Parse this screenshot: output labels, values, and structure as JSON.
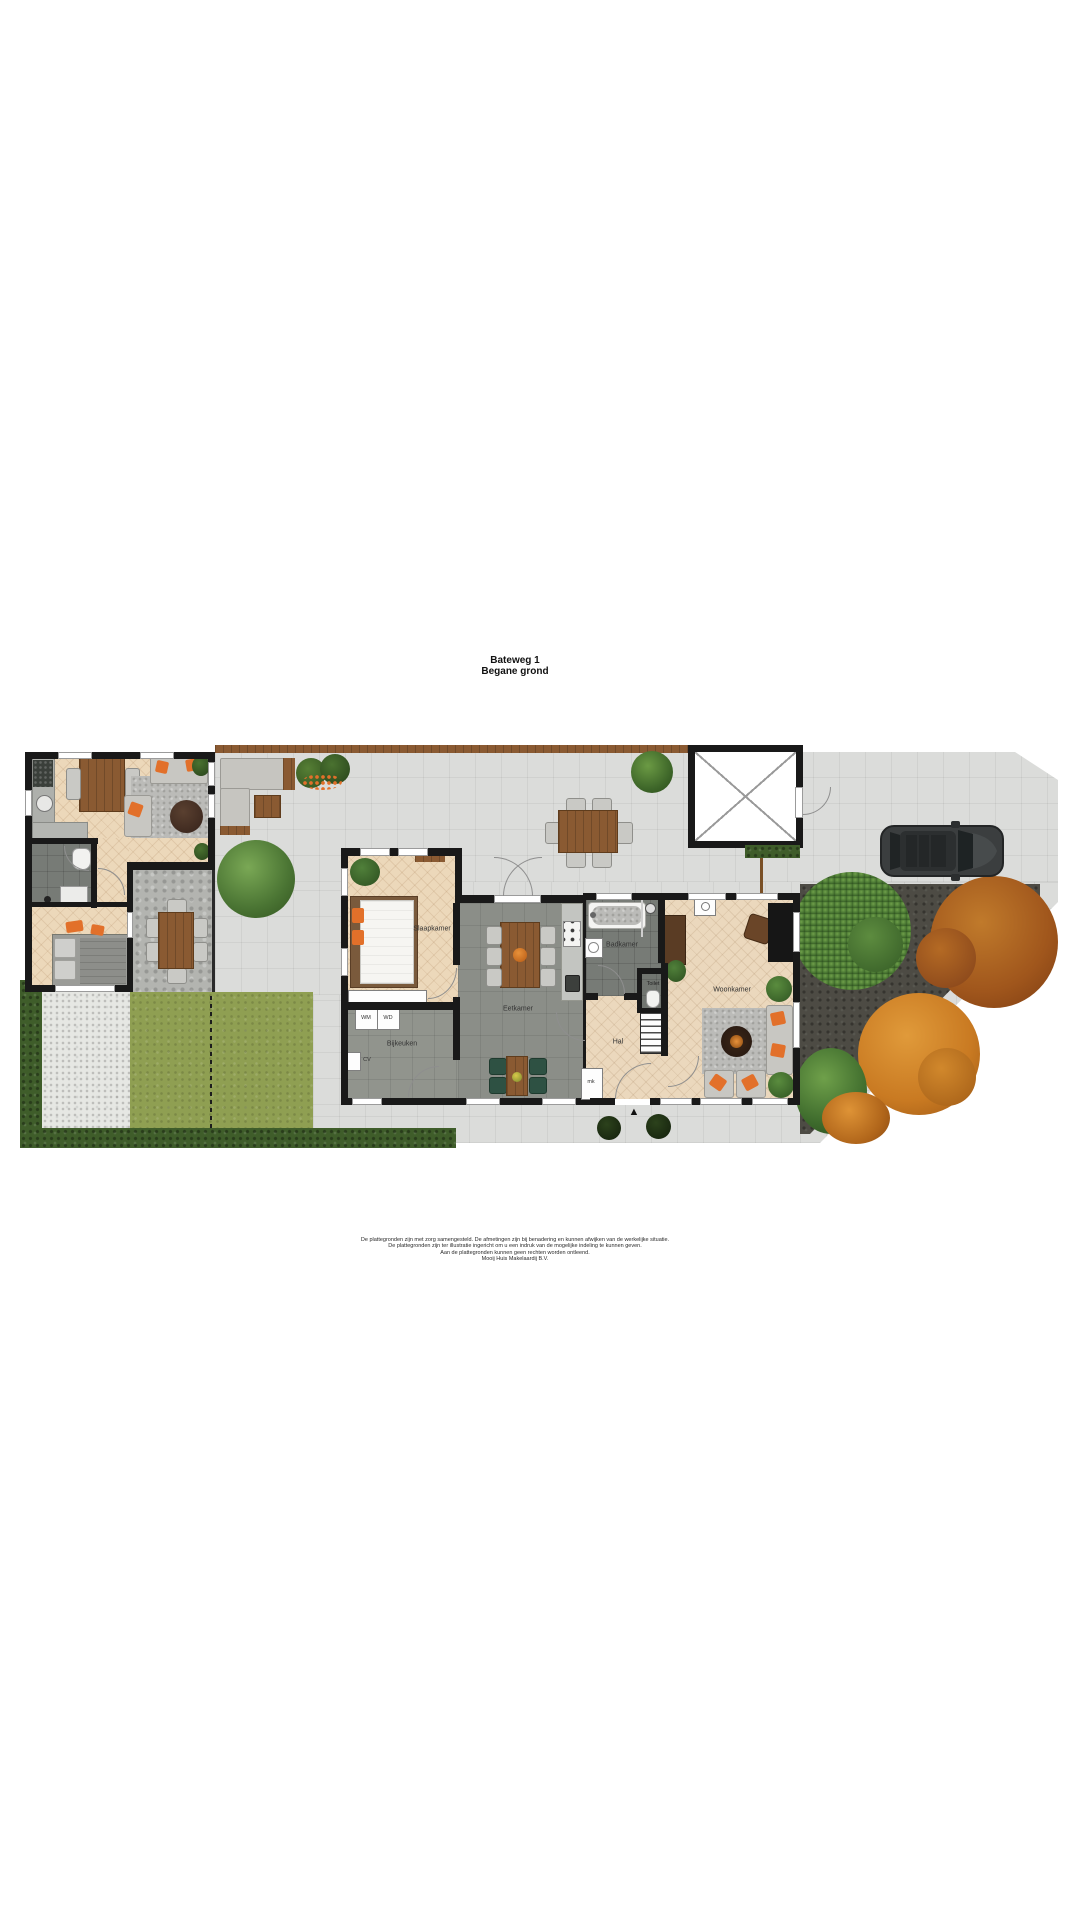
{
  "title": {
    "line1": "Bateweg 1",
    "line2": "Begane grond"
  },
  "rooms": {
    "slaapkamer": "Slaapkamer",
    "bijkeuken": "Bijkeuken",
    "eetkamer": "Eetkamer",
    "badkamer": "Badkamer",
    "toilet": "Toilet",
    "hal": "Hal",
    "woonkamer": "Woonkamer"
  },
  "appliances": {
    "wm": "WM",
    "wd": "WD",
    "cv": "CV",
    "mk": "mk"
  },
  "icons": {
    "north_arrow": "▲"
  },
  "disclaimer": {
    "line1": "De plattegronden zijn met zorg samengesteld. De afmetingen zijn bij benadering en kunnen afwijken van de werkelijke situatie.",
    "line2": "De plattegronden zijn ter illustratie ingericht om u een indruk van de mogelijke indeling te kunnen geven.",
    "line3": "Aan de plattegronden kunnen geen rechten worden ontleend.",
    "line4": "Mooij Huis Makelaardij B.V."
  },
  "colors": {
    "wall": "#191919",
    "paving": "#dbdcda",
    "wood_floor": "#ecd8ba",
    "gray_tile": "#8b8e88",
    "dark_tile": "#777b76",
    "grass": "#8f9f52",
    "hedge": "#3f5d2a",
    "soil": "#4d4b44",
    "accent_orange": "#e2702a",
    "tree_green": "#4c7a33",
    "tree_rust": "#a0561c",
    "tree_orange": "#c97a22",
    "car_body": "#3b3e3f"
  }
}
